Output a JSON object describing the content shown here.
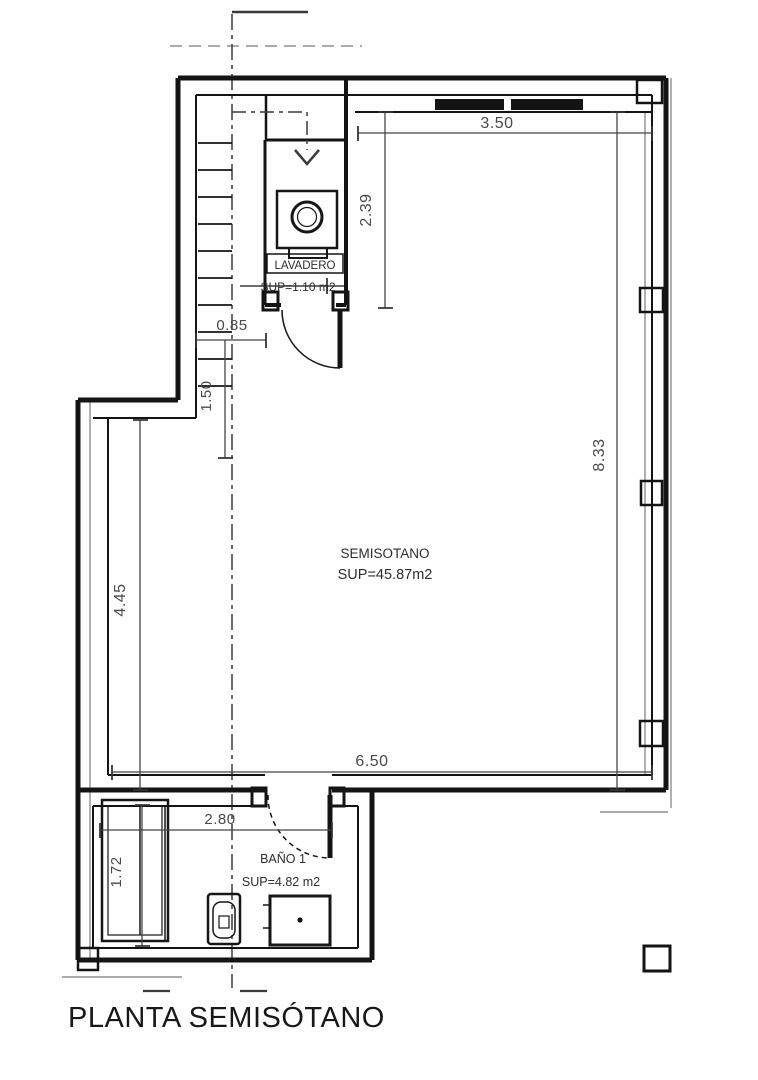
{
  "title": "PLANTA SEMISÓTANO",
  "colors": {
    "wall_line": "#141414",
    "dimension_text": "#4a4a4a",
    "secondary_line": "#8f8f8f",
    "background": "#fefefe"
  },
  "rooms": {
    "semisotano": {
      "name": "SEMISOTANO",
      "area": "SUP=45.87m2"
    },
    "lavadero": {
      "name": "LAVADERO",
      "area": "SUP=1.10 m2"
    },
    "bano": {
      "name": "BAÑO 1",
      "area": "SUP=4.82 m2"
    }
  },
  "dimensions": {
    "top_width": "3.50",
    "lavadero_height": "2.39",
    "stair_width": "0.85",
    "stair_run": "1.50",
    "right_height": "8.33",
    "left_height": "4.45",
    "bottom_width": "6.50",
    "bano_width": "2.80",
    "bano_height": "1.72"
  }
}
